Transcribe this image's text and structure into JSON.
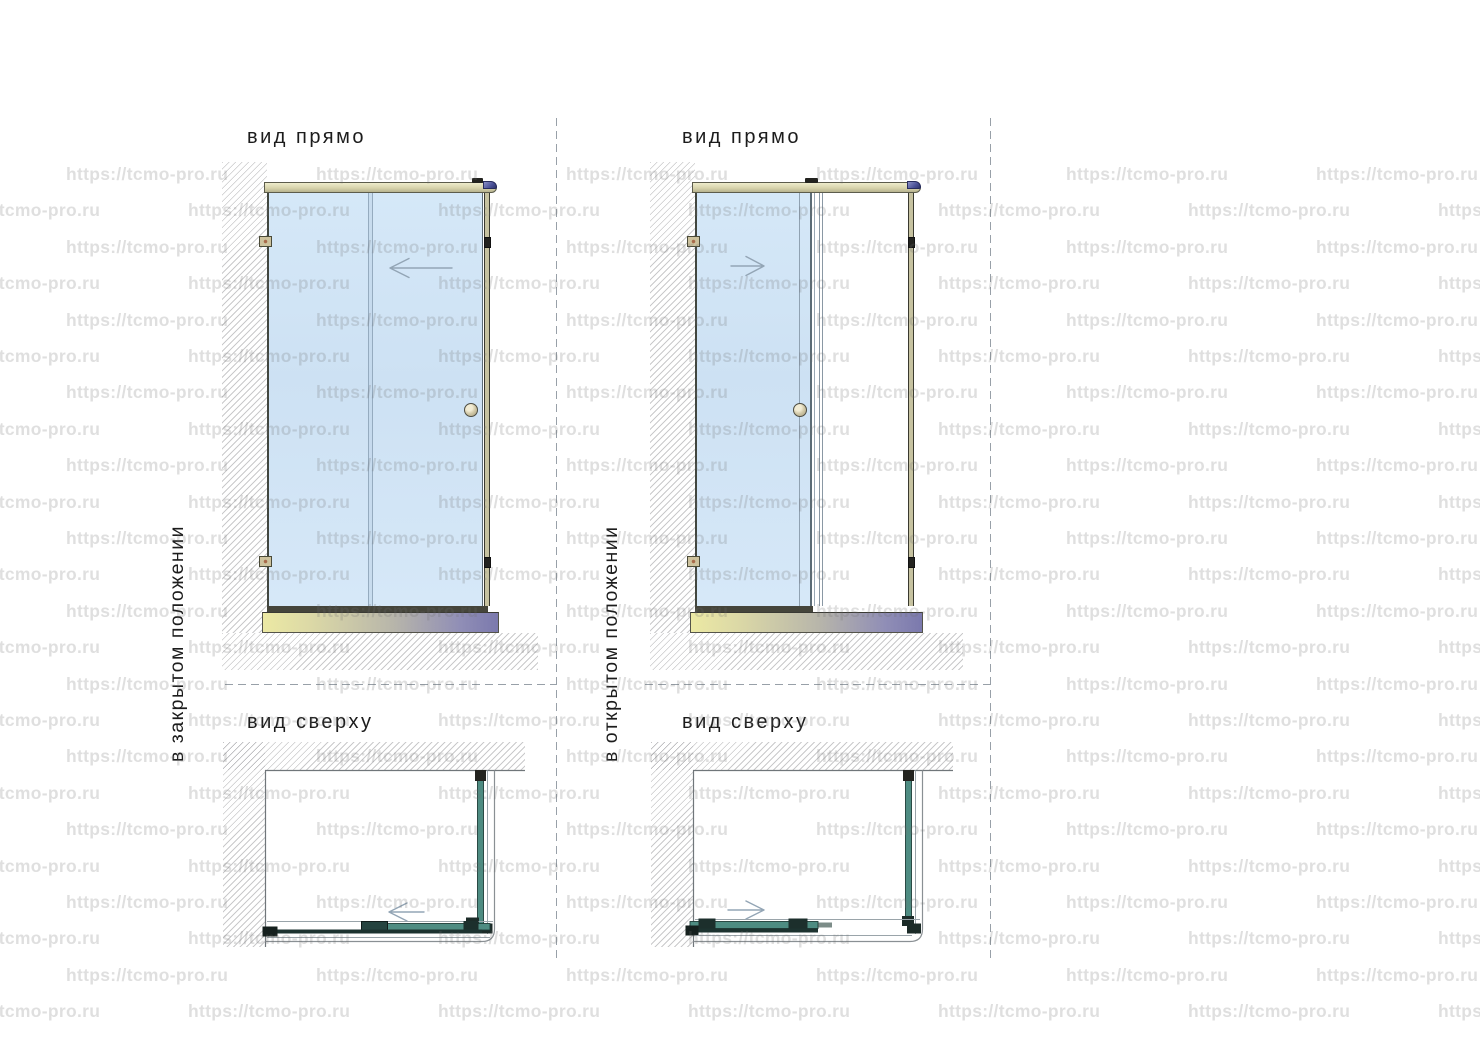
{
  "document": {
    "type": "technical-drawing",
    "subject": "shower enclosure with sliding door, front and top views"
  },
  "watermark": {
    "text": "https://tcmo-pro.ru",
    "color": "rgba(110,110,110,0.22)"
  },
  "sections": {
    "closed": {
      "side_label": "в закрытом положении",
      "front_title": "вид прямо",
      "top_title": "вид сверху"
    },
    "open": {
      "side_label": "в открытом положении",
      "front_title": "вид прямо",
      "top_title": "вид сверху"
    }
  },
  "colors": {
    "glass": "#d6e8f8",
    "rail_cap": "#4a5198",
    "base_left": "#ece9a4",
    "base_right": "#7b79ad",
    "plan_glass": "#4e8c82",
    "dash_line": "#98a0a8"
  }
}
